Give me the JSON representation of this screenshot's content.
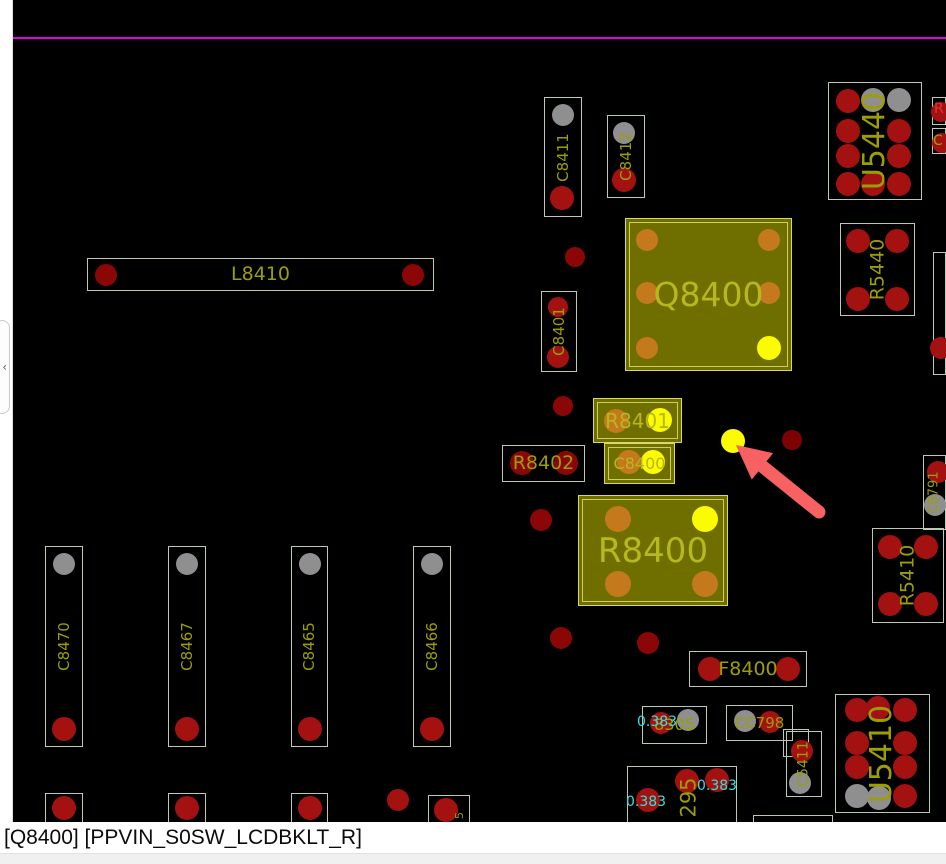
{
  "app": {
    "status_bar": {
      "text": "[Q8400] [PPVIN_S0SW_LCDBKLT_R]"
    },
    "flyout": {
      "chevron_icon": "‹"
    }
  },
  "colors": {
    "board_bg": "#000000",
    "outline_normal": "#b9cab9",
    "highlight_fill": "#6f6f00",
    "highlight_border": "#d9d960",
    "label_olive": "#9c9e04",
    "label_bright": "#b6b81e",
    "pad_red": "#a31111",
    "pad_darkred": "#8b0606",
    "pad_darkred2": "#7d0202",
    "pad_gray": "#8f8f8f",
    "pad_orange": "#c5791d",
    "pad_yellow": "#fbfb02",
    "net_cyan": "#35e0e0",
    "letter_red": "#e03434",
    "magenta": "#e002e0",
    "arrow": "#f86161"
  },
  "board": {
    "magenta_line_y": 37,
    "components": [
      {
        "id": "C8411",
        "label": "C8411",
        "x": 544,
        "y": 97,
        "w": 38,
        "h": 120,
        "vertical": true,
        "label_size": 15,
        "pads": [
          {
            "cx": 563,
            "cy": 115,
            "r": 11,
            "color": "gray"
          },
          {
            "cx": 562,
            "cy": 198,
            "r": 12,
            "color": "red"
          }
        ]
      },
      {
        "id": "C8412",
        "label": "C8412",
        "x": 607,
        "y": 115,
        "w": 38,
        "h": 83,
        "vertical": true,
        "label_size": 15,
        "pads": [
          {
            "cx": 624,
            "cy": 133,
            "r": 11,
            "color": "gray"
          },
          {
            "cx": 624,
            "cy": 180,
            "r": 12,
            "color": "red"
          }
        ]
      },
      {
        "id": "U5440",
        "label": "U5440",
        "x": 828,
        "y": 82,
        "w": 94,
        "h": 118,
        "vertical": true,
        "label_size": 30,
        "pads": [
          {
            "cx": 848,
            "cy": 101,
            "r": 12,
            "color": "red"
          },
          {
            "cx": 873,
            "cy": 100,
            "r": 12,
            "color": "gray"
          },
          {
            "cx": 899,
            "cy": 100,
            "r": 12,
            "color": "gray"
          },
          {
            "cx": 848,
            "cy": 131,
            "r": 12,
            "color": "red"
          },
          {
            "cx": 899,
            "cy": 131,
            "r": 12,
            "color": "red"
          },
          {
            "cx": 848,
            "cy": 156,
            "r": 12,
            "color": "red"
          },
          {
            "cx": 899,
            "cy": 156,
            "r": 12,
            "color": "red"
          },
          {
            "cx": 848,
            "cy": 184,
            "r": 12,
            "color": "red"
          },
          {
            "cx": 873,
            "cy": 184,
            "r": 12,
            "color": "red"
          },
          {
            "cx": 899,
            "cy": 184,
            "r": 12,
            "color": "red"
          }
        ]
      },
      {
        "id": "R5440",
        "label": "R5440",
        "x": 840,
        "y": 223,
        "w": 75,
        "h": 93,
        "vertical": true,
        "label_size": 19,
        "pads": [
          {
            "cx": 858,
            "cy": 241,
            "r": 12,
            "color": "red"
          },
          {
            "cx": 897,
            "cy": 241,
            "r": 12,
            "color": "red"
          },
          {
            "cx": 858,
            "cy": 299,
            "r": 12,
            "color": "red"
          },
          {
            "cx": 897,
            "cy": 299,
            "r": 12,
            "color": "red"
          }
        ]
      },
      {
        "id": "L8410",
        "label": "L8410",
        "x": 87,
        "y": 258,
        "w": 347,
        "h": 33,
        "label_size": 19,
        "pads": [
          {
            "cx": 106,
            "cy": 275,
            "r": 11,
            "color": "darkred"
          },
          {
            "cx": 413,
            "cy": 275,
            "r": 11,
            "color": "darkred"
          }
        ]
      },
      {
        "id": "C8401",
        "label": "C8401",
        "x": 541,
        "y": 291,
        "w": 36,
        "h": 81,
        "vertical": true,
        "label_size": 15,
        "pads": [
          {
            "cx": 558,
            "cy": 307,
            "r": 10,
            "color": "red"
          },
          {
            "cx": 558,
            "cy": 357,
            "r": 11,
            "color": "red"
          }
        ]
      },
      {
        "id": "Q8400",
        "label": "Q8400",
        "x": 625,
        "y": 218,
        "w": 167,
        "h": 153,
        "highlighted": true,
        "label_size": 33,
        "pads": [
          {
            "cx": 647,
            "cy": 240,
            "r": 11,
            "color": "orange"
          },
          {
            "cx": 769,
            "cy": 240,
            "r": 11,
            "color": "orange"
          },
          {
            "cx": 647,
            "cy": 293,
            "r": 11,
            "color": "orange"
          },
          {
            "cx": 769,
            "cy": 293,
            "r": 11,
            "color": "orange"
          },
          {
            "cx": 647,
            "cy": 348,
            "r": 11,
            "color": "orange"
          },
          {
            "cx": 769,
            "cy": 348,
            "r": 12,
            "color": "yellow"
          }
        ]
      },
      {
        "id": "R8401",
        "label": "R8401",
        "x": 593,
        "y": 398,
        "w": 89,
        "h": 45,
        "highlighted": true,
        "label_size": 20,
        "pads": [
          {
            "cx": 616,
            "cy": 421,
            "r": 12,
            "color": "orange"
          },
          {
            "cx": 660,
            "cy": 420,
            "r": 12,
            "color": "yellow"
          }
        ]
      },
      {
        "id": "R8402",
        "label": "R8402",
        "x": 502,
        "y": 445,
        "w": 83,
        "h": 37,
        "label_size": 19,
        "pads": [
          {
            "cx": 522,
            "cy": 463,
            "r": 12,
            "color": "darkred"
          },
          {
            "cx": 566,
            "cy": 463,
            "r": 12,
            "color": "darkred"
          }
        ]
      },
      {
        "id": "C8400",
        "label": "C8400",
        "x": 604,
        "y": 443,
        "w": 71,
        "h": 41,
        "highlighted": true,
        "label_size": 16,
        "pads": [
          {
            "cx": 629,
            "cy": 462,
            "r": 12,
            "color": "orange"
          },
          {
            "cx": 653,
            "cy": 462,
            "r": 12,
            "color": "yellow"
          }
        ]
      },
      {
        "id": "R8400",
        "label": "R8400",
        "x": 578,
        "y": 495,
        "w": 150,
        "h": 111,
        "highlighted": true,
        "label_size": 34,
        "pads": [
          {
            "cx": 618,
            "cy": 519,
            "r": 13,
            "color": "orange"
          },
          {
            "cx": 705,
            "cy": 519,
            "r": 13,
            "color": "yellow"
          },
          {
            "cx": 618,
            "cy": 584,
            "r": 13,
            "color": "orange"
          },
          {
            "cx": 705,
            "cy": 584,
            "r": 13,
            "color": "orange"
          }
        ]
      },
      {
        "id": "C8791",
        "label": "C8791",
        "x": 923,
        "y": 455,
        "w": 23,
        "h": 75,
        "vertical": true,
        "label_size": 13,
        "pads": [
          {
            "cx": 938,
            "cy": 472,
            "r": 11,
            "color": "red"
          },
          {
            "cx": 935,
            "cy": 505,
            "r": 11,
            "color": "gray"
          }
        ]
      },
      {
        "id": "R5410",
        "label": "R5410",
        "x": 872,
        "y": 528,
        "w": 72,
        "h": 95,
        "vertical": true,
        "label_size": 19,
        "pads": [
          {
            "cx": 890,
            "cy": 547,
            "r": 12,
            "color": "red"
          },
          {
            "cx": 926,
            "cy": 547,
            "r": 12,
            "color": "red"
          },
          {
            "cx": 890,
            "cy": 604,
            "r": 12,
            "color": "red"
          },
          {
            "cx": 926,
            "cy": 604,
            "r": 12,
            "color": "red"
          }
        ]
      },
      {
        "id": "C8470",
        "label": "C8470",
        "x": 45,
        "y": 546,
        "w": 38,
        "h": 201,
        "vertical": true,
        "label_size": 15,
        "pads": [
          {
            "cx": 64,
            "cy": 564,
            "r": 11,
            "color": "gray"
          },
          {
            "cx": 64,
            "cy": 729,
            "r": 12,
            "color": "red"
          }
        ]
      },
      {
        "id": "C8467",
        "label": "C8467",
        "x": 168,
        "y": 546,
        "w": 38,
        "h": 201,
        "vertical": true,
        "label_size": 15,
        "pads": [
          {
            "cx": 187,
            "cy": 564,
            "r": 11,
            "color": "gray"
          },
          {
            "cx": 187,
            "cy": 729,
            "r": 12,
            "color": "red"
          }
        ]
      },
      {
        "id": "C8465",
        "label": "C8465",
        "x": 291,
        "y": 546,
        "w": 37,
        "h": 201,
        "vertical": true,
        "label_size": 15,
        "pads": [
          {
            "cx": 310,
            "cy": 564,
            "r": 11,
            "color": "gray"
          },
          {
            "cx": 310,
            "cy": 729,
            "r": 12,
            "color": "red"
          }
        ]
      },
      {
        "id": "C8466",
        "label": "C8466",
        "x": 413,
        "y": 546,
        "w": 38,
        "h": 201,
        "vertical": true,
        "label_size": 15,
        "pads": [
          {
            "cx": 432,
            "cy": 564,
            "r": 11,
            "color": "gray"
          },
          {
            "cx": 432,
            "cy": 729,
            "r": 12,
            "color": "red"
          }
        ]
      },
      {
        "id": "F8400",
        "label": "F8400",
        "x": 689,
        "y": 651,
        "w": 118,
        "h": 36,
        "label_size": 19,
        "pads": [
          {
            "cx": 710,
            "cy": 669,
            "r": 12,
            "color": "red"
          },
          {
            "cx": 788,
            "cy": 669,
            "r": 12,
            "color": "red"
          }
        ]
      },
      {
        "id": "C8305",
        "label": "8305",
        "x": 642,
        "y": 706,
        "w": 65,
        "h": 38,
        "label_size": 16,
        "pads": [
          {
            "cx": 661,
            "cy": 723,
            "r": 11,
            "color": "red"
          },
          {
            "cx": 688,
            "cy": 720,
            "r": 11,
            "color": "gray"
          }
        ]
      },
      {
        "id": "CC798",
        "label": "CC798",
        "x": 726,
        "y": 705,
        "w": 67,
        "h": 36,
        "label_size": 15,
        "pads": [
          {
            "cx": 745,
            "cy": 721,
            "r": 11,
            "color": "gray"
          },
          {
            "cx": 770,
            "cy": 722,
            "r": 11,
            "color": "red"
          }
        ]
      },
      {
        "id": "C5411-frame",
        "label": "",
        "x": 783,
        "y": 729,
        "w": 26,
        "h": 28,
        "pads": []
      },
      {
        "id": "C5411",
        "label": "C5411",
        "x": 786,
        "y": 731,
        "w": 36,
        "h": 66,
        "vertical": true,
        "label_size": 14,
        "pads": [
          {
            "cx": 802,
            "cy": 751,
            "r": 11,
            "color": "red"
          },
          {
            "cx": 800,
            "cy": 783,
            "r": 11,
            "color": "gray"
          }
        ]
      },
      {
        "id": "U5410",
        "label": "U5410",
        "x": 835,
        "y": 694,
        "w": 95,
        "h": 119,
        "vertical": true,
        "label_size": 30,
        "pads": [
          {
            "cx": 857,
            "cy": 710,
            "r": 12,
            "color": "red"
          },
          {
            "cx": 878,
            "cy": 708,
            "r": 12,
            "color": "red"
          },
          {
            "cx": 905,
            "cy": 710,
            "r": 12,
            "color": "red"
          },
          {
            "cx": 857,
            "cy": 743,
            "r": 12,
            "color": "red"
          },
          {
            "cx": 905,
            "cy": 743,
            "r": 12,
            "color": "red"
          },
          {
            "cx": 857,
            "cy": 767,
            "r": 12,
            "color": "red"
          },
          {
            "cx": 905,
            "cy": 767,
            "r": 12,
            "color": "red"
          },
          {
            "cx": 857,
            "cy": 796,
            "r": 12,
            "color": "gray"
          },
          {
            "cx": 879,
            "cy": 798,
            "r": 12,
            "color": "gray"
          },
          {
            "cx": 905,
            "cy": 796,
            "r": 12,
            "color": "red"
          }
        ]
      },
      {
        "id": "C8295",
        "label": "",
        "x": 627,
        "y": 766,
        "w": 110,
        "h": 57,
        "pads": [
          {
            "cx": 687,
            "cy": 781,
            "r": 12,
            "color": "red"
          },
          {
            "cx": 717,
            "cy": 780,
            "r": 12,
            "color": "red"
          },
          {
            "cx": 648,
            "cy": 800,
            "r": 12,
            "color": "red"
          }
        ]
      },
      {
        "id": "cap-b1",
        "label": "",
        "x": 45,
        "y": 793,
        "w": 38,
        "h": 30,
        "pads": [
          {
            "cx": 64,
            "cy": 808,
            "r": 12,
            "color": "red"
          }
        ]
      },
      {
        "id": "cap-b2",
        "label": "",
        "x": 168,
        "y": 793,
        "w": 38,
        "h": 30,
        "pads": [
          {
            "cx": 187,
            "cy": 808,
            "r": 12,
            "color": "red"
          }
        ]
      },
      {
        "id": "cap-b3",
        "label": "",
        "x": 291,
        "y": 793,
        "w": 37,
        "h": 30,
        "pads": [
          {
            "cx": 310,
            "cy": 808,
            "r": 12,
            "color": "red"
          }
        ]
      },
      {
        "id": "cap-b4",
        "label": "",
        "x": 428,
        "y": 795,
        "w": 42,
        "h": 28,
        "pads": [
          {
            "cx": 446,
            "cy": 810,
            "r": 12,
            "color": "red"
          }
        ]
      },
      {
        "id": "frag-bottom",
        "label": "",
        "x": 753,
        "y": 815,
        "w": 80,
        "h": 9,
        "pads": []
      },
      {
        "id": "frag-right-1",
        "label": "",
        "x": 932,
        "y": 97,
        "w": 14,
        "h": 28,
        "pads": [
          {
            "cx": 941,
            "cy": 112,
            "r": 10,
            "color": "red"
          }
        ]
      },
      {
        "id": "frag-right-2",
        "label": "",
        "x": 932,
        "y": 128,
        "w": 14,
        "h": 26,
        "pads": [
          {
            "cx": 942,
            "cy": 143,
            "r": 10,
            "color": "red"
          }
        ]
      },
      {
        "id": "frag-right-3",
        "label": "",
        "x": 933,
        "y": 252,
        "w": 13,
        "h": 123,
        "pads": [
          {
            "cx": 941,
            "cy": 348,
            "r": 11,
            "color": "red"
          }
        ]
      }
    ],
    "floating_pads": [
      {
        "cx": 575,
        "cy": 257,
        "r": 10,
        "color": "darkred"
      },
      {
        "cx": 563,
        "cy": 406,
        "r": 10,
        "color": "darkred"
      },
      {
        "cx": 541,
        "cy": 520,
        "r": 11,
        "color": "darkred"
      },
      {
        "cx": 561,
        "cy": 638,
        "r": 11,
        "color": "darkred"
      },
      {
        "cx": 648,
        "cy": 643,
        "r": 11,
        "color": "darkred"
      },
      {
        "cx": 792,
        "cy": 440,
        "r": 10,
        "color": "darkred2"
      },
      {
        "cx": 398,
        "cy": 800,
        "r": 11,
        "color": "red"
      }
    ],
    "highlight_dot": {
      "cx": 733,
      "cy": 441,
      "r": 12,
      "color": "yellow"
    },
    "texts": [
      {
        "text": "0.383",
        "x": 637,
        "y": 715,
        "color": "cyan",
        "size": 14
      },
      {
        "text": "0.383",
        "x": 697,
        "y": 779,
        "color": "cyan",
        "size": 14
      },
      {
        "text": "0.383",
        "x": 626,
        "y": 795,
        "color": "cyan",
        "size": 14
      },
      {
        "text": "295",
        "x": 672,
        "y": 772,
        "color": "olive",
        "size": 21,
        "rotate": -90,
        "w": 34,
        "h": 50
      },
      {
        "text": "5",
        "x": 452,
        "y": 808,
        "color": "olive",
        "size": 11,
        "rotate": -90,
        "w": 14,
        "h": 14
      },
      {
        "text": "R",
        "x": 934,
        "y": 102,
        "color": "letter_red",
        "size": 14
      },
      {
        "text": "C",
        "x": 933,
        "y": 134,
        "color": "olive",
        "size": 14
      }
    ],
    "annotation_arrow": {
      "tip": {
        "x": 736,
        "y": 445
      },
      "tail": {
        "x": 819,
        "y": 512
      },
      "shaft_width": 13,
      "head_length": 34,
      "head_half_width": 17
    }
  }
}
